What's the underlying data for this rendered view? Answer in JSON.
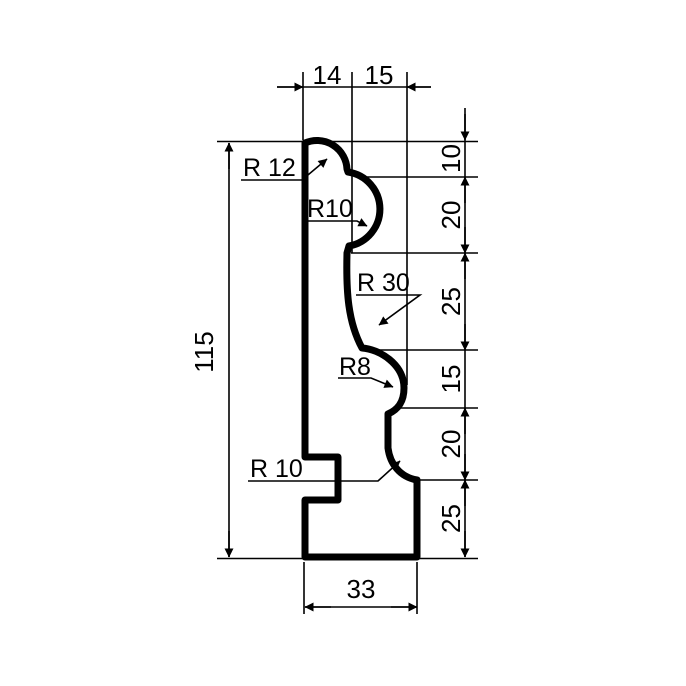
{
  "drawing": {
    "type": "technical-profile-drawing",
    "background": "#ffffff",
    "line_color": "#000000"
  },
  "labels": {
    "top": [
      "14",
      "15"
    ],
    "left": "115",
    "right": [
      "10",
      "20",
      "25",
      "15",
      "20",
      "25"
    ],
    "bottom": "33",
    "radii": [
      "R 12",
      "R10",
      "R 30",
      "R8",
      "R 10"
    ]
  }
}
